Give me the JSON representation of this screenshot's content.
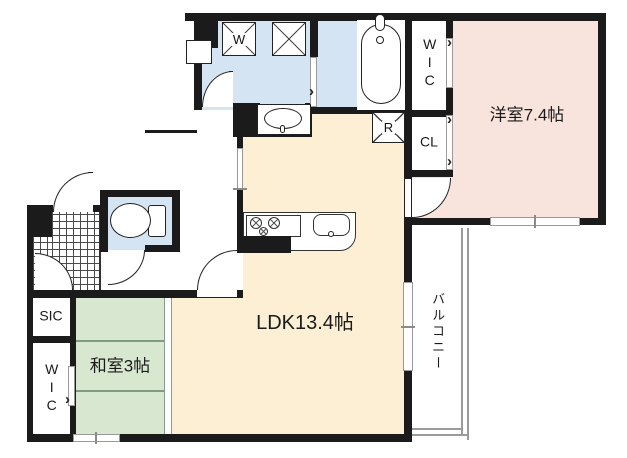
{
  "plan_title": "apartment-floor-plan",
  "rooms": {
    "ldk": "LDK13.4帖",
    "western_room": "洋室7.4帖",
    "japanese_room": "和室3帖",
    "balcony": "バルコニー",
    "wic_upper": "WIC",
    "wic_lower": "WIC",
    "closet": "CL",
    "shoe_closet": "SIC"
  },
  "appliances": {
    "washer": "W",
    "refrigerator": "R"
  },
  "colors": {
    "wall": "#1b1b1b",
    "wet_area_floor": "#d4e4f2",
    "ldk_floor": "#fcefd3",
    "western_floor": "#f9e4dd",
    "tatami_floor": "#d8e7cf",
    "railing": "#9a9a9a"
  }
}
